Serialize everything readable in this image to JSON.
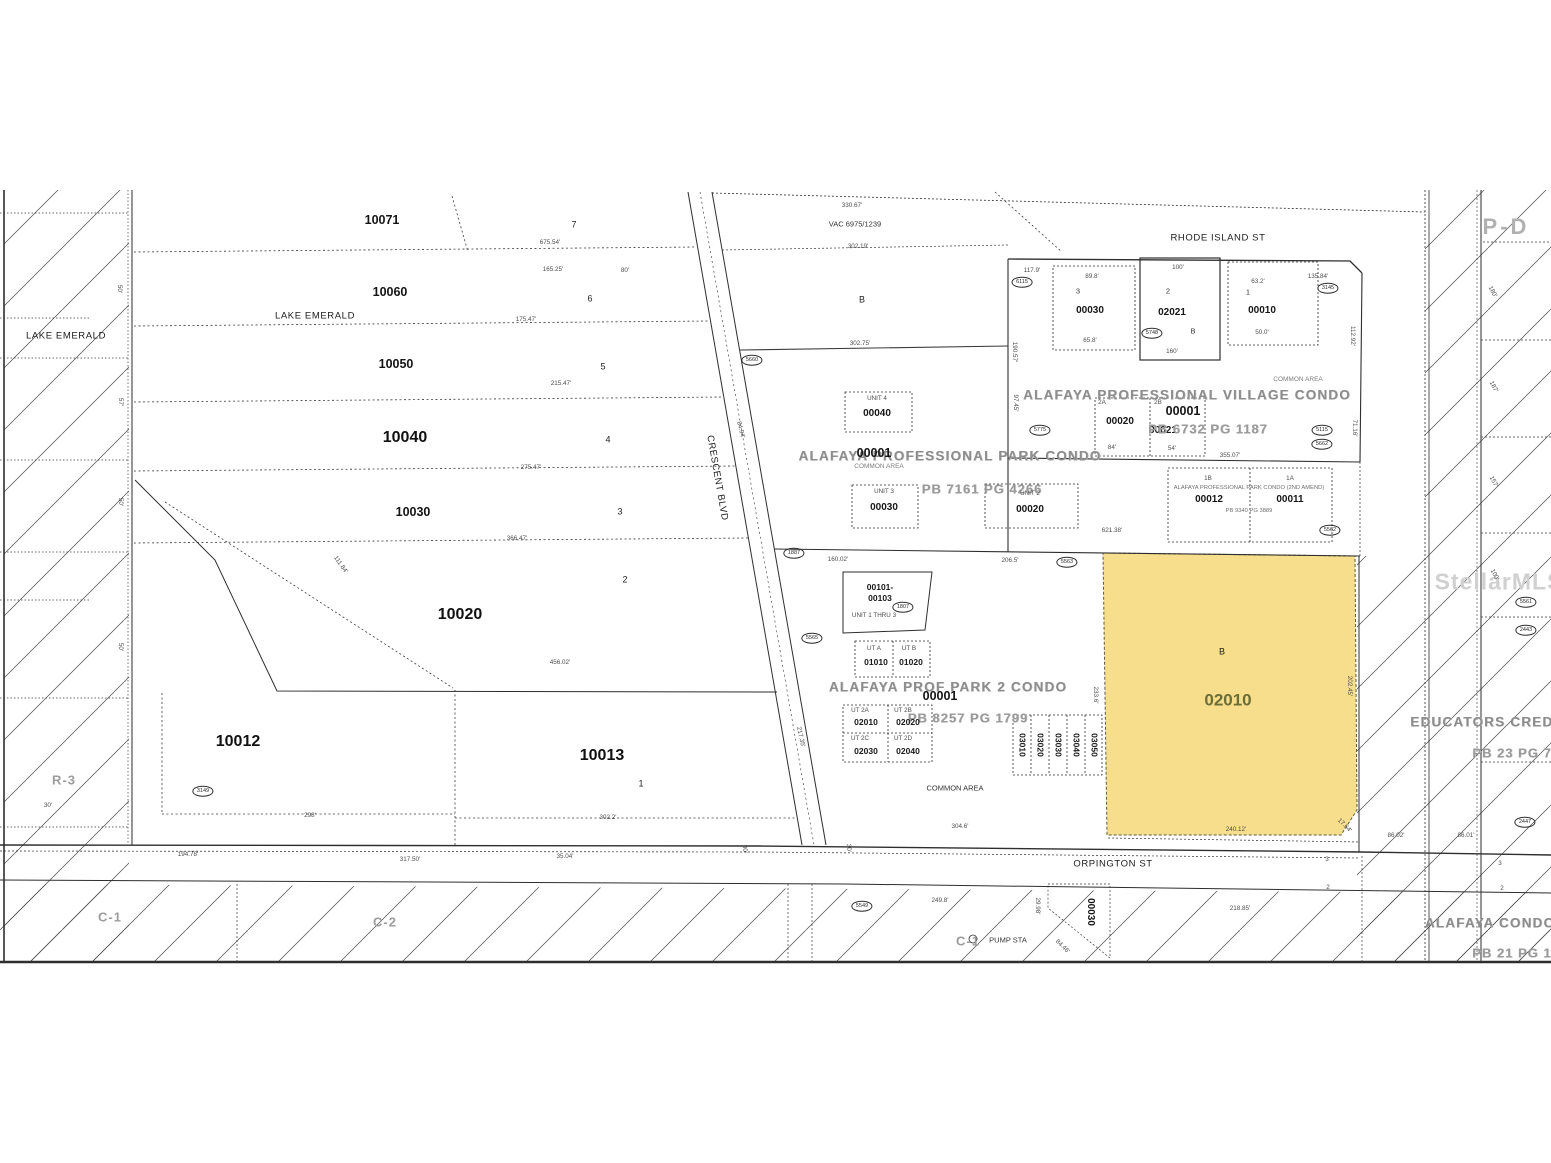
{
  "colors": {
    "highlight": "#f6de8d",
    "highlight_label": "#6d6d35",
    "paper": "#ffffff",
    "line": "#2e2e2e"
  },
  "map": {
    "watermark": "StellarMLS",
    "highlighted_parcel": {
      "id": "02010",
      "block": "B"
    },
    "labels": [
      {
        "t": "RHODE ISLAND ST",
        "x": 1218,
        "y": 238,
        "c": "street",
        "n": "street-rhode-island"
      },
      {
        "t": "CRESCENT BLVD",
        "x": 717,
        "y": 478,
        "c": "street",
        "r": 80,
        "n": "street-crescent-blvd"
      },
      {
        "t": "ORPINGTON ST",
        "x": 1113,
        "y": 864,
        "c": "street",
        "n": "street-orpington"
      },
      {
        "t": "LAKE EMERALD",
        "x": 66,
        "y": 336,
        "c": "street",
        "n": "lake-emerald-left"
      },
      {
        "t": "LAKE EMERALD",
        "x": 315,
        "y": 316,
        "c": "street",
        "n": "lake-emerald-row"
      },
      {
        "t": "P-D",
        "x": 1506,
        "y": 227,
        "c": "zone-xl",
        "n": "zone-pd"
      },
      {
        "t": "R-3",
        "x": 64,
        "y": 780,
        "c": "zone",
        "n": "zone-r3"
      },
      {
        "t": "C-1",
        "x": 110,
        "y": 917,
        "c": "zone",
        "n": "zone-c1-left"
      },
      {
        "t": "C-2",
        "x": 385,
        "y": 922,
        "c": "zone",
        "n": "zone-c2"
      },
      {
        "t": "C-1",
        "x": 968,
        "y": 941,
        "c": "zone",
        "n": "zone-c1-mid"
      },
      {
        "t": "StellarMLS",
        "x": 1499,
        "y": 582,
        "c": "wm",
        "n": "watermark"
      },
      {
        "t": "EDUCATORS CREDIT",
        "x": 1489,
        "y": 722,
        "c": "condo",
        "n": "educators-credit-label"
      },
      {
        "t": "PB 23 PG 7",
        "x": 1512,
        "y": 753,
        "c": "ref"
      },
      {
        "t": "ALAFAYA CONDO",
        "x": 1490,
        "y": 923,
        "c": "condo",
        "n": "alafaya-condo-label"
      },
      {
        "t": "PB 21 PG 18",
        "x": 1516,
        "y": 953,
        "c": "ref"
      },
      {
        "t": "10071",
        "x": 382,
        "y": 220,
        "c": "pid",
        "n": "parcel-10071"
      },
      {
        "t": "10060",
        "x": 390,
        "y": 292,
        "c": "pid",
        "n": "parcel-10060"
      },
      {
        "t": "10050",
        "x": 396,
        "y": 364,
        "c": "pid",
        "n": "parcel-10050"
      },
      {
        "t": "10040",
        "x": 405,
        "y": 438,
        "c": "pid-lg",
        "n": "parcel-10040"
      },
      {
        "t": "10030",
        "x": 413,
        "y": 512,
        "c": "pid",
        "n": "parcel-10030"
      },
      {
        "t": "10020",
        "x": 460,
        "y": 615,
        "c": "pid-lg",
        "n": "parcel-10020"
      },
      {
        "t": "10012",
        "x": 238,
        "y": 742,
        "c": "pid-lg",
        "n": "parcel-10012"
      },
      {
        "t": "10013",
        "x": 602,
        "y": 756,
        "c": "pid-lg",
        "n": "parcel-10013"
      },
      {
        "t": "7",
        "x": 574,
        "y": 225,
        "c": "lot"
      },
      {
        "t": "6",
        "x": 590,
        "y": 299,
        "c": "lot"
      },
      {
        "t": "5",
        "x": 603,
        "y": 367,
        "c": "lot"
      },
      {
        "t": "4",
        "x": 608,
        "y": 440,
        "c": "lot"
      },
      {
        "t": "3",
        "x": 620,
        "y": 512,
        "c": "lot"
      },
      {
        "t": "2",
        "x": 625,
        "y": 580,
        "c": "lot"
      },
      {
        "t": "1",
        "x": 641,
        "y": 784,
        "c": "lot"
      },
      {
        "t": "675.54'",
        "x": 550,
        "y": 243,
        "c": "tiny2"
      },
      {
        "t": "165.25'",
        "x": 553,
        "y": 270,
        "c": "tiny2"
      },
      {
        "t": "80'",
        "x": 625,
        "y": 271,
        "c": "tiny2"
      },
      {
        "t": "175.47'",
        "x": 526,
        "y": 320,
        "c": "tiny2"
      },
      {
        "t": "215.47'",
        "x": 561,
        "y": 384,
        "c": "tiny2"
      },
      {
        "t": "275.47'",
        "x": 531,
        "y": 468,
        "c": "tiny2"
      },
      {
        "t": "366.47'",
        "x": 517,
        "y": 539,
        "c": "tiny2"
      },
      {
        "t": "456.02'",
        "x": 560,
        "y": 663,
        "c": "tiny2"
      },
      {
        "t": "111.84'",
        "x": 340,
        "y": 565,
        "c": "tiny2",
        "r": 55
      },
      {
        "t": "298'",
        "x": 310,
        "y": 816,
        "c": "tiny2"
      },
      {
        "t": "302.2'",
        "x": 608,
        "y": 818,
        "c": "tiny2"
      },
      {
        "t": "194.78'",
        "x": 188,
        "y": 855,
        "c": "tiny2"
      },
      {
        "t": "317.50'",
        "x": 410,
        "y": 860,
        "c": "tiny2"
      },
      {
        "t": "35.04'",
        "x": 565,
        "y": 857,
        "c": "tiny2"
      },
      {
        "t": "50'",
        "x": 119,
        "y": 289,
        "c": "tiny2",
        "r": 90
      },
      {
        "t": "57'",
        "x": 120,
        "y": 402,
        "c": "tiny2",
        "r": 90
      },
      {
        "t": "50'",
        "x": 120,
        "y": 502,
        "c": "tiny2",
        "r": 90
      },
      {
        "t": "50'",
        "x": 120,
        "y": 647,
        "c": "tiny2",
        "r": 90
      },
      {
        "t": "30'",
        "x": 48,
        "y": 806,
        "c": "tiny2"
      },
      {
        "t": "30'",
        "x": 744,
        "y": 849,
        "c": "tiny2",
        "r": 85
      },
      {
        "t": "30'",
        "x": 848,
        "y": 848,
        "c": "tiny2",
        "r": 85
      },
      {
        "t": "330.67'",
        "x": 852,
        "y": 206,
        "c": "tiny2"
      },
      {
        "t": "VAC 6975/1239",
        "x": 855,
        "y": 224,
        "c": "tiny"
      },
      {
        "t": "302.19'",
        "x": 858,
        "y": 247,
        "c": "tiny2"
      },
      {
        "t": "B",
        "x": 862,
        "y": 300,
        "c": "lot"
      },
      {
        "t": "302.75'",
        "x": 860,
        "y": 344,
        "c": "tiny2"
      },
      {
        "t": "3",
        "x": 1078,
        "y": 291,
        "c": "tiny"
      },
      {
        "t": "00030",
        "x": 1090,
        "y": 311,
        "c": "unit",
        "n": "unit-00030-village"
      },
      {
        "t": "89.8'",
        "x": 1092,
        "y": 277,
        "c": "tiny2"
      },
      {
        "t": "65.8'",
        "x": 1090,
        "y": 341,
        "c": "tiny2"
      },
      {
        "t": "2",
        "x": 1168,
        "y": 291,
        "c": "tiny"
      },
      {
        "t": "02021",
        "x": 1172,
        "y": 313,
        "c": "unit",
        "n": "unit-02021"
      },
      {
        "t": "B",
        "x": 1193,
        "y": 331,
        "c": "tiny"
      },
      {
        "t": "100'",
        "x": 1178,
        "y": 268,
        "c": "tiny2"
      },
      {
        "t": "160'",
        "x": 1172,
        "y": 352,
        "c": "tiny2"
      },
      {
        "t": "1",
        "x": 1248,
        "y": 292,
        "c": "tiny"
      },
      {
        "t": "00010",
        "x": 1262,
        "y": 311,
        "c": "unit",
        "n": "unit-00010"
      },
      {
        "t": "63.2'",
        "x": 1258,
        "y": 282,
        "c": "tiny2"
      },
      {
        "t": "50.0'",
        "x": 1262,
        "y": 333,
        "c": "tiny2"
      },
      {
        "t": "117.9'",
        "x": 1032,
        "y": 271,
        "c": "tiny2"
      },
      {
        "t": "135.84'",
        "x": 1318,
        "y": 277,
        "c": "tiny2"
      },
      {
        "t": "190.57'",
        "x": 1014,
        "y": 352,
        "c": "tiny2",
        "r": 90
      },
      {
        "t": "112.92'",
        "x": 1352,
        "y": 336,
        "c": "tiny2",
        "r": 90
      },
      {
        "t": "71.16'",
        "x": 1354,
        "y": 428,
        "c": "tiny2",
        "r": 90
      },
      {
        "t": "COMMON AREA",
        "x": 1298,
        "y": 380,
        "c": "condo-sm"
      },
      {
        "t": "ALAFAYA PROFESSIONAL VILLAGE CONDO",
        "x": 1187,
        "y": 395,
        "c": "condo",
        "n": "village-condo-title"
      },
      {
        "t": "00001",
        "x": 1183,
        "y": 411,
        "c": "pid"
      },
      {
        "t": "2A",
        "x": 1102,
        "y": 403,
        "c": "tiny2"
      },
      {
        "t": "00020",
        "x": 1120,
        "y": 422,
        "c": "unit",
        "n": "unit-00020-village"
      },
      {
        "t": "2B",
        "x": 1158,
        "y": 403,
        "c": "tiny2"
      },
      {
        "t": "00021",
        "x": 1163,
        "y": 431,
        "c": "unit",
        "n": "unit-00021"
      },
      {
        "t": "PB 6732 PG 1187",
        "x": 1208,
        "y": 429,
        "c": "ref",
        "n": "village-condo-plat-ref"
      },
      {
        "t": "84'",
        "x": 1112,
        "y": 448,
        "c": "tiny2"
      },
      {
        "t": "54'",
        "x": 1172,
        "y": 449,
        "c": "tiny2"
      },
      {
        "t": "355.07'",
        "x": 1230,
        "y": 456,
        "c": "tiny2"
      },
      {
        "t": "1B",
        "x": 1208,
        "y": 479,
        "c": "tiny2"
      },
      {
        "t": "1A",
        "x": 1290,
        "y": 479,
        "c": "tiny2"
      },
      {
        "t": "ALAFAYA PROFESSIONAL PARK CONDO (2ND AMEND)",
        "x": 1249,
        "y": 489,
        "c": "condo-xs",
        "n": "park-condo-2nd-amend-title"
      },
      {
        "t": "00012",
        "x": 1209,
        "y": 500,
        "c": "unit",
        "n": "unit-00012"
      },
      {
        "t": "00011",
        "x": 1290,
        "y": 500,
        "c": "unit",
        "n": "unit-00011"
      },
      {
        "t": "PB 9340 PG 3889",
        "x": 1249,
        "y": 512,
        "c": "condo-xs"
      },
      {
        "t": "621.38'",
        "x": 1112,
        "y": 531,
        "c": "tiny2"
      },
      {
        "t": "UNIT 4",
        "x": 877,
        "y": 399,
        "c": "tiny2"
      },
      {
        "t": "00040",
        "x": 877,
        "y": 414,
        "c": "unit",
        "n": "unit-00040"
      },
      {
        "t": "ALAFAYA PROFESSIONAL PARK CONDO",
        "x": 950,
        "y": 456,
        "c": "condo",
        "n": "park-condo-title"
      },
      {
        "t": "00001",
        "x": 874,
        "y": 453,
        "c": "pid"
      },
      {
        "t": "COMMON AREA",
        "x": 879,
        "y": 467,
        "c": "condo-sm"
      },
      {
        "t": "PB 7161 PG 4266",
        "x": 982,
        "y": 489,
        "c": "ref",
        "n": "park-condo-plat-ref"
      },
      {
        "t": "UNIT 3",
        "x": 884,
        "y": 492,
        "c": "tiny2"
      },
      {
        "t": "00030",
        "x": 884,
        "y": 508,
        "c": "unit",
        "n": "unit-00030-park"
      },
      {
        "t": "UNIT 2",
        "x": 1030,
        "y": 494,
        "c": "tiny2"
      },
      {
        "t": "00020",
        "x": 1030,
        "y": 510,
        "c": "unit",
        "n": "unit-00020-park"
      },
      {
        "t": "97.45'",
        "x": 1015,
        "y": 403,
        "c": "tiny2",
        "r": 90
      },
      {
        "t": "84.94'",
        "x": 740,
        "y": 430,
        "c": "tiny2",
        "r": 75
      },
      {
        "t": "160.02'",
        "x": 838,
        "y": 560,
        "c": "tiny2"
      },
      {
        "t": "206.5'",
        "x": 1010,
        "y": 561,
        "c": "tiny2"
      },
      {
        "t": "00101-",
        "x": 880,
        "y": 587,
        "c": "unit-sm"
      },
      {
        "t": "00103",
        "x": 880,
        "y": 598,
        "c": "unit-sm",
        "n": "unit-00101-00103"
      },
      {
        "t": "UNIT 1 THRU 3",
        "x": 874,
        "y": 616,
        "c": "tiny2"
      },
      {
        "t": "ALAFAYA PROF PARK 2 CONDO",
        "x": 948,
        "y": 687,
        "c": "condo",
        "n": "prof-park-2-condo-title"
      },
      {
        "t": "00001",
        "x": 940,
        "y": 696,
        "c": "pid"
      },
      {
        "t": "PB 8257 PG 1799",
        "x": 968,
        "y": 718,
        "c": "ref",
        "n": "prof-park-2-plat-ref"
      },
      {
        "t": "UT A",
        "x": 874,
        "y": 649,
        "c": "tiny2"
      },
      {
        "t": "UT B",
        "x": 909,
        "y": 649,
        "c": "tiny2"
      },
      {
        "t": "01010",
        "x": 876,
        "y": 662,
        "c": "unit-sm",
        "n": "unit-01010"
      },
      {
        "t": "01020",
        "x": 911,
        "y": 662,
        "c": "unit-sm",
        "n": "unit-01020"
      },
      {
        "t": "UT 2A",
        "x": 860,
        "y": 711,
        "c": "tiny2"
      },
      {
        "t": "02010",
        "x": 866,
        "y": 722,
        "c": "unit-sm",
        "n": "unit-02010-sm"
      },
      {
        "t": "UT 2B",
        "x": 903,
        "y": 711,
        "c": "tiny2"
      },
      {
        "t": "02020",
        "x": 908,
        "y": 722,
        "c": "unit-sm",
        "n": "unit-02020"
      },
      {
        "t": "UT 2C",
        "x": 860,
        "y": 739,
        "c": "tiny2"
      },
      {
        "t": "02030",
        "x": 866,
        "y": 751,
        "c": "unit-sm",
        "n": "unit-02030"
      },
      {
        "t": "UT 2D",
        "x": 903,
        "y": 739,
        "c": "tiny2"
      },
      {
        "t": "02040",
        "x": 908,
        "y": 751,
        "c": "unit-sm",
        "n": "unit-02040"
      },
      {
        "t": "03010",
        "x": 1022,
        "y": 745,
        "c": "unit-sm",
        "r": 90,
        "n": "unit-03010"
      },
      {
        "t": "03020",
        "x": 1040,
        "y": 745,
        "c": "unit-sm",
        "r": 90,
        "n": "unit-03020"
      },
      {
        "t": "03030",
        "x": 1058,
        "y": 745,
        "c": "unit-sm",
        "r": 90,
        "n": "unit-03030"
      },
      {
        "t": "03040",
        "x": 1076,
        "y": 745,
        "c": "unit-sm",
        "r": 90,
        "n": "unit-03040"
      },
      {
        "t": "03050",
        "x": 1094,
        "y": 745,
        "c": "unit-sm",
        "r": 90,
        "n": "unit-03050"
      },
      {
        "t": "COMMON AREA",
        "x": 955,
        "y": 788,
        "c": "tiny"
      },
      {
        "t": "304.6'",
        "x": 960,
        "y": 827,
        "c": "tiny2"
      },
      {
        "t": "233.6'",
        "x": 1095,
        "y": 695,
        "c": "tiny2",
        "r": 90
      },
      {
        "t": "217.35'",
        "x": 800,
        "y": 737,
        "c": "tiny2",
        "r": 78
      },
      {
        "t": "B",
        "x": 1222,
        "y": 652,
        "c": "lot",
        "n": "highlighted-parcel-block"
      },
      {
        "t": "02010",
        "x": 1228,
        "y": 700,
        "c": "hl-id",
        "n": "highlighted-parcel-label"
      },
      {
        "t": "240.12'",
        "x": 1236,
        "y": 830,
        "c": "tiny2"
      },
      {
        "t": "202.45'",
        "x": 1349,
        "y": 686,
        "c": "tiny2",
        "r": 90
      },
      {
        "t": "17.64'",
        "x": 1344,
        "y": 826,
        "c": "tiny2",
        "r": 45
      },
      {
        "t": "180'",
        "x": 1492,
        "y": 292,
        "c": "tiny2",
        "r": 62
      },
      {
        "t": "187'",
        "x": 1493,
        "y": 387,
        "c": "tiny2",
        "r": 62
      },
      {
        "t": "157'",
        "x": 1493,
        "y": 482,
        "c": "tiny2",
        "r": 62
      },
      {
        "t": "100'",
        "x": 1494,
        "y": 575,
        "c": "tiny2",
        "r": 62
      },
      {
        "t": "86.02'",
        "x": 1396,
        "y": 836,
        "c": "tiny2"
      },
      {
        "t": "86.01'",
        "x": 1466,
        "y": 836,
        "c": "tiny2"
      },
      {
        "t": "PUMP STA",
        "x": 1008,
        "y": 940,
        "c": "tiny",
        "n": "pump-station-label"
      },
      {
        "t": "00030",
        "x": 1090,
        "y": 912,
        "c": "unit",
        "r": 90,
        "n": "unit-00030-bottom"
      },
      {
        "t": "249.8'",
        "x": 940,
        "y": 901,
        "c": "tiny2"
      },
      {
        "t": "218.85'",
        "x": 1240,
        "y": 909,
        "c": "tiny2"
      },
      {
        "t": "29.98'",
        "x": 1037,
        "y": 906,
        "c": "tiny2",
        "r": 90
      },
      {
        "t": "84.46'",
        "x": 1062,
        "y": 947,
        "c": "tiny2",
        "r": 45
      },
      {
        "t": "3",
        "x": 1327,
        "y": 860,
        "c": "tiny2"
      },
      {
        "t": "2",
        "x": 1328,
        "y": 888,
        "c": "tiny2"
      },
      {
        "t": "3",
        "x": 1500,
        "y": 864,
        "c": "tiny2"
      },
      {
        "t": "2",
        "x": 1502,
        "y": 889,
        "c": "tiny2"
      }
    ],
    "circle_markers": [
      {
        "t": "6115",
        "x": 1022,
        "y": 282
      },
      {
        "t": "5748",
        "x": 1152,
        "y": 333
      },
      {
        "t": "3145",
        "x": 1328,
        "y": 288
      },
      {
        "t": "5775",
        "x": 1040,
        "y": 430
      },
      {
        "t": "5115",
        "x": 1322,
        "y": 430
      },
      {
        "t": "5660",
        "x": 752,
        "y": 360
      },
      {
        "t": "1887",
        "x": 794,
        "y": 553
      },
      {
        "t": "5563",
        "x": 1067,
        "y": 562
      },
      {
        "t": "1807",
        "x": 903,
        "y": 607
      },
      {
        "t": "5565",
        "x": 812,
        "y": 638
      },
      {
        "t": "5662",
        "x": 1322,
        "y": 444
      },
      {
        "t": "5562",
        "x": 1330,
        "y": 530
      },
      {
        "t": "3149",
        "x": 203,
        "y": 791
      },
      {
        "t": "5549",
        "x": 862,
        "y": 906
      },
      {
        "t": "2447",
        "x": 1525,
        "y": 822
      },
      {
        "t": "5561",
        "x": 1526,
        "y": 602
      },
      {
        "t": "2443",
        "x": 1526,
        "y": 630
      }
    ]
  }
}
